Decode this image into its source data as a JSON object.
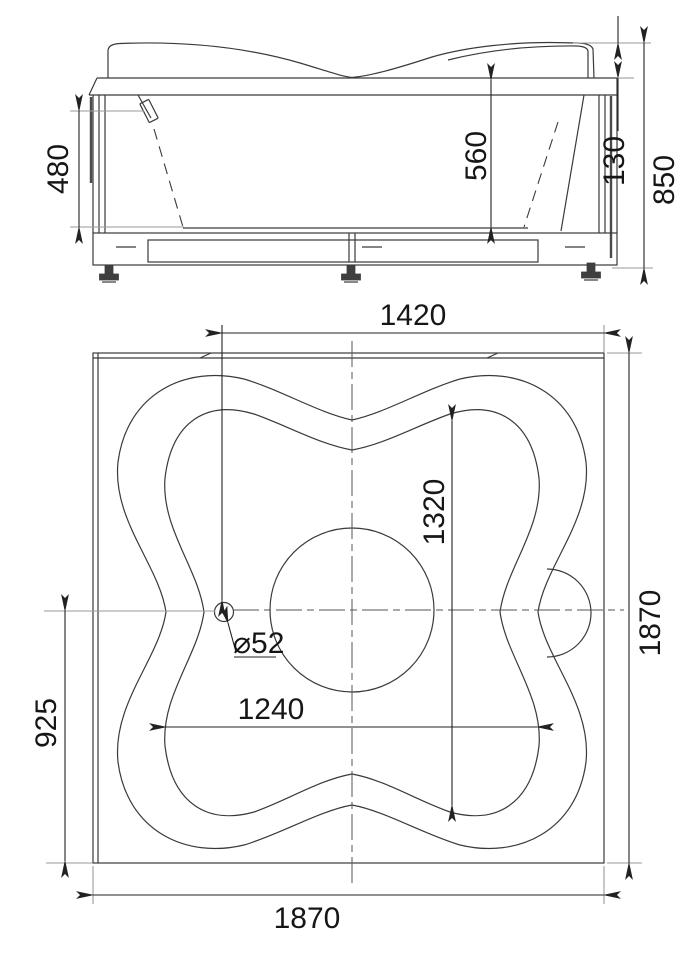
{
  "drawing": {
    "side_view": {
      "dims": {
        "depth_front": "480",
        "depth_basin": "560",
        "headrest_height": "130",
        "total_height": "850"
      }
    },
    "plan_view": {
      "dims": {
        "drain_to_right_edge": "1420",
        "basin_length": "1320",
        "drain_diameter": "⌀52",
        "basin_width": "1240",
        "drain_to_front_edge": "925",
        "overall_depth": "1870",
        "overall_width": "1870"
      }
    }
  }
}
